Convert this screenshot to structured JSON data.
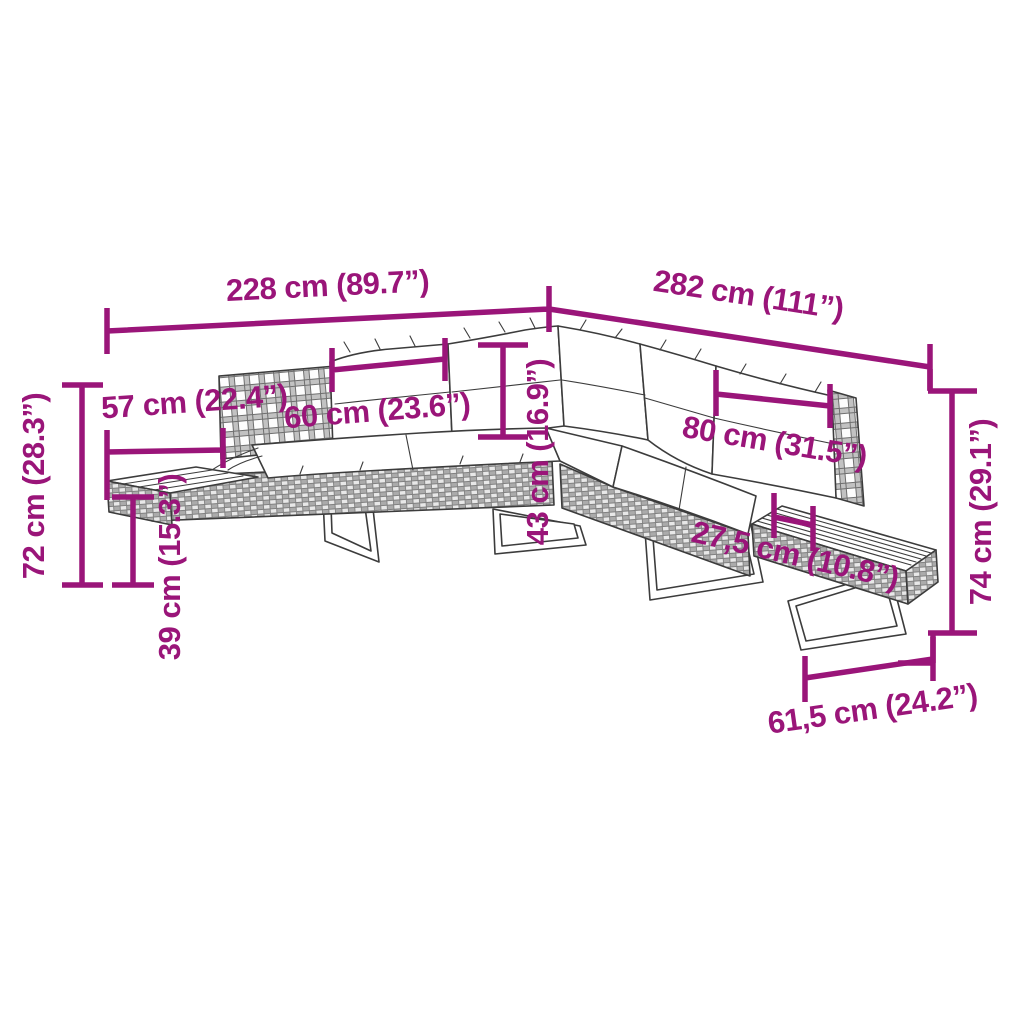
{
  "figure": {
    "type": "product-dimension-diagram",
    "subject": "L-shaped rattan garden corner sofa with bench table",
    "background_color": "#ffffff",
    "accent_color": "#9A1579",
    "line_color": "#3C3C3C"
  },
  "dims": [
    {
      "id": "overall-width-left",
      "label": "228 cm (89.7”)"
    },
    {
      "id": "overall-width-right",
      "label": "282 cm (111”)"
    },
    {
      "id": "left-end-depth",
      "label": "57 cm (22.4”)"
    },
    {
      "id": "overall-height",
      "label": "72 cm (28.3”)"
    },
    {
      "id": "back-cushion-width",
      "label": "60 cm (23.6”)"
    },
    {
      "id": "back-cushion-height",
      "label": "43 cm (16.9”)"
    },
    {
      "id": "seat-height",
      "label": "39 cm (15.3”)"
    },
    {
      "id": "right-cushion-width",
      "label": "80 cm (31.5”)"
    },
    {
      "id": "table-offset",
      "label": "27,5 cm (10.8”)"
    },
    {
      "id": "right-end-height",
      "label": "74 cm (29.1”)"
    },
    {
      "id": "table-width",
      "label": "61,5 cm (24.2”)"
    }
  ]
}
